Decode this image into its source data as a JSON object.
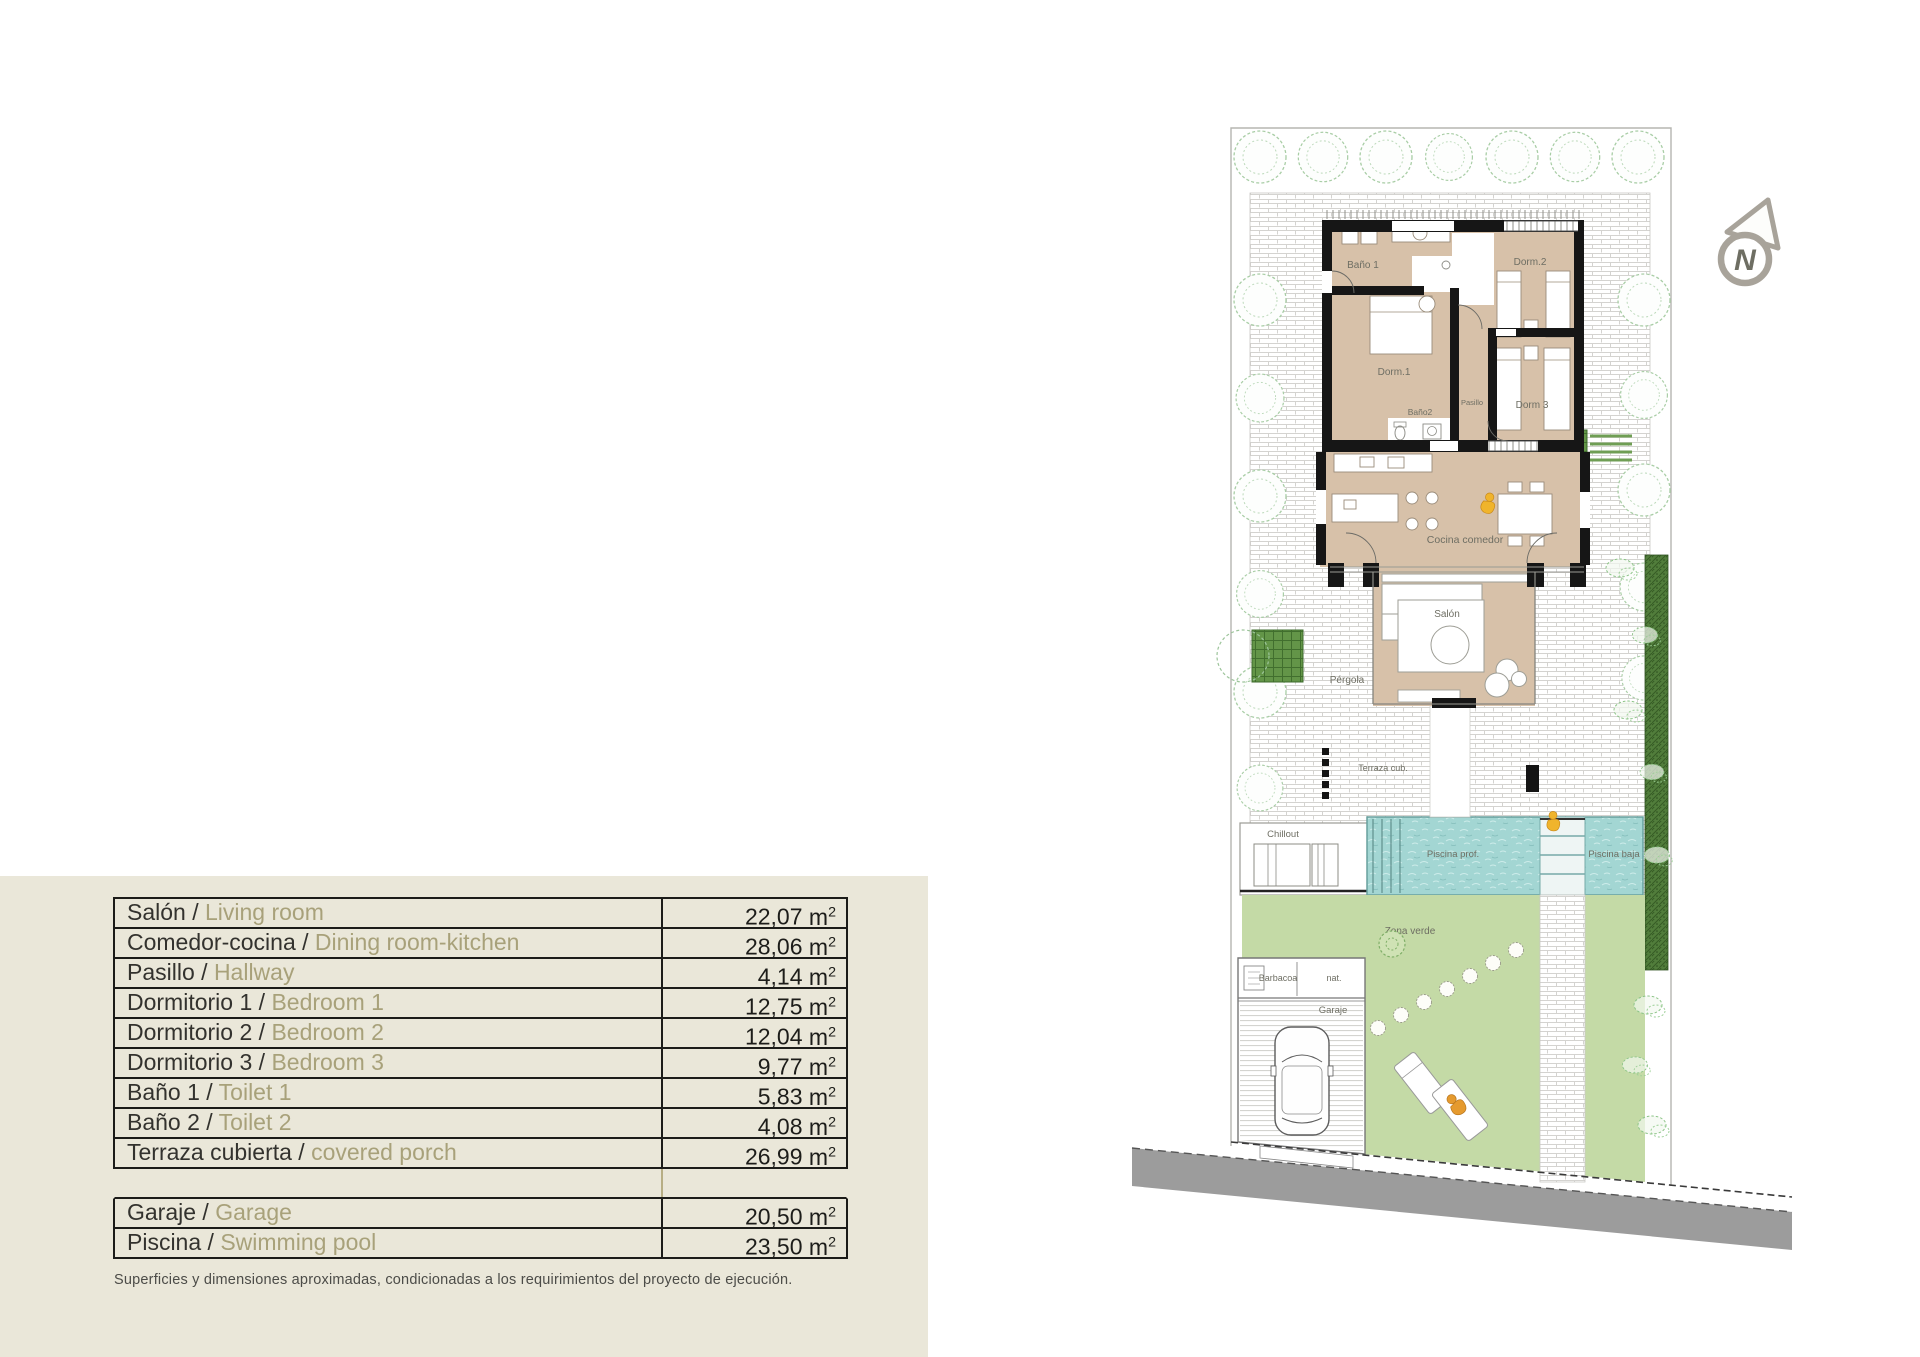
{
  "page": {
    "background": "#ffffff",
    "panel_background": "#eae7d9"
  },
  "areas_table": {
    "separator": " / ",
    "unit_base": "m",
    "unit_sup": "2",
    "disclaimer": "Superficies y dimensiones aproximadas, condicionadas a los requirimientos del proyecto de ejecución.",
    "rows": [
      {
        "es": "Salón",
        "en": "Living room",
        "area": "22,07"
      },
      {
        "es": "Comedor-cocina",
        "en": "Dining room-kitchen",
        "area": "28,06"
      },
      {
        "es": "Pasillo",
        "en": "Hallway",
        "area": "4,14"
      },
      {
        "es": "Dormitorio 1",
        "en": "Bedroom 1",
        "area": "12,75"
      },
      {
        "es": "Dormitorio 2",
        "en": "Bedroom 2",
        "area": "12,04"
      },
      {
        "es": "Dormitorio 3",
        "en": "Bedroom 3",
        "area": "9,77"
      },
      {
        "es": "Baño 1",
        "en": "Toilet 1",
        "area": "5,83"
      },
      {
        "es": "Baño 2",
        "en": "Toilet 2",
        "area": "4,08"
      },
      {
        "es": "Terraza cubierta",
        "en": "covered porch",
        "area": "26,99"
      },
      {
        "empty": true
      },
      {
        "es": "Garaje",
        "en": "Garage",
        "area": "20,50"
      },
      {
        "es": "Piscina",
        "en": "Swimming pool",
        "area": "23,50"
      }
    ]
  },
  "site_plan": {
    "compass": "N",
    "labels": {
      "bano1": "Baño 1",
      "dorm1": "Dorm.1",
      "dorm2": "Dorm.2",
      "dorm3": "Dorm 3",
      "pasillo": "Pasillo",
      "bano2": "Baño2",
      "cocina": "Cocina comedor",
      "salon": "Salón",
      "pergola": "Pérgola",
      "terraza": "Terraza cub.",
      "chillout": "Chillout",
      "piscina_prof": "Piscina prof.",
      "piscina_baja": "Piscina baja",
      "zona_verde": "Zona verde",
      "barbacoa": "Barbacoa",
      "barbacoa_tipo": "nat.",
      "garaje": "Garaje"
    },
    "colors": {
      "room_tan": "#d7c1a9",
      "wall_black": "#161616",
      "pool_water": "#a3d6d3",
      "lawn_green": "#c4daa6",
      "hedge_green": "#517d3b",
      "planter_green": "#639548",
      "street_gray": "#9c9c9c",
      "compass_gray": "#a8a39a",
      "accent_yellow": "#f0b42c",
      "accent_orange": "#e59a2e",
      "table_divider_tan": "#b7ae84",
      "english_olive": "#a8a17a"
    }
  }
}
